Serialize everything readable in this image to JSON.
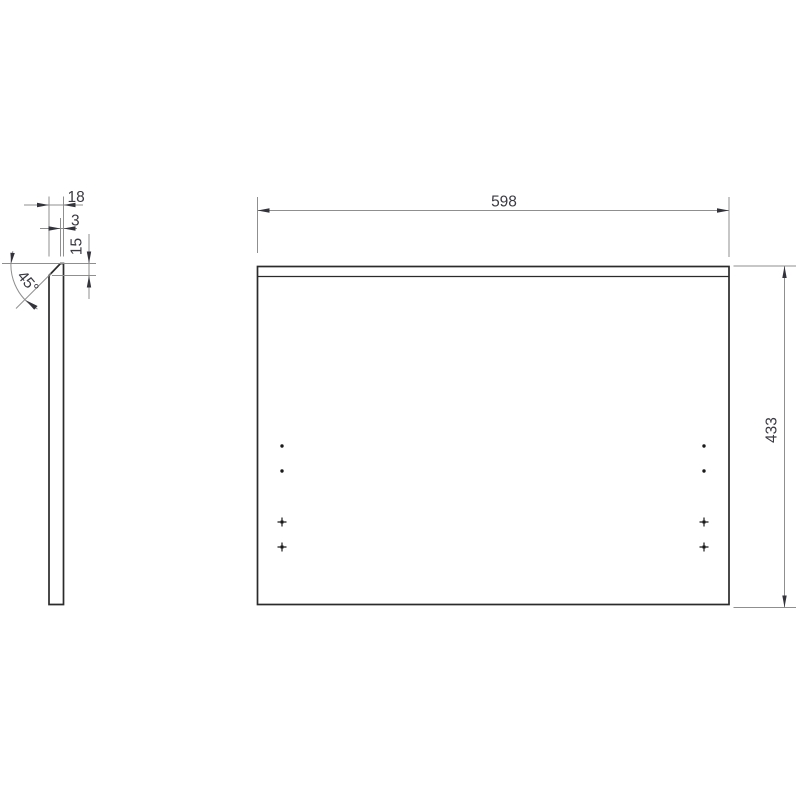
{
  "page": {
    "background": "#ffffff",
    "description": "Technical drawing of a chamfered rectangular panel: side profile view (left) and front view (right) with drill-hole markers"
  },
  "dimensions": {
    "front_width": "598",
    "front_height": "433",
    "side_thickness": "18",
    "side_top_flat": "3",
    "side_chamfer_height": "15",
    "side_chamfer_angle": "45°"
  },
  "colors": {
    "outline": "#2b2b2b",
    "dimension_lines": "#8f8f8f",
    "dimension_text": "#3a3a42",
    "arrowheads": "#33333b",
    "hole_marks": "#1a1a1a",
    "background": "#ffffff"
  },
  "hole_markers": [
    {
      "type": "dot",
      "x": 282,
      "y": 446
    },
    {
      "type": "dot",
      "x": 282,
      "y": 471
    },
    {
      "type": "cross",
      "x": 282,
      "y": 522
    },
    {
      "type": "cross",
      "x": 282,
      "y": 547
    },
    {
      "type": "dot",
      "x": 704,
      "y": 446
    },
    {
      "type": "dot",
      "x": 704,
      "y": 471
    },
    {
      "type": "cross",
      "x": 704,
      "y": 522
    },
    {
      "type": "cross",
      "x": 704,
      "y": 547
    }
  ]
}
